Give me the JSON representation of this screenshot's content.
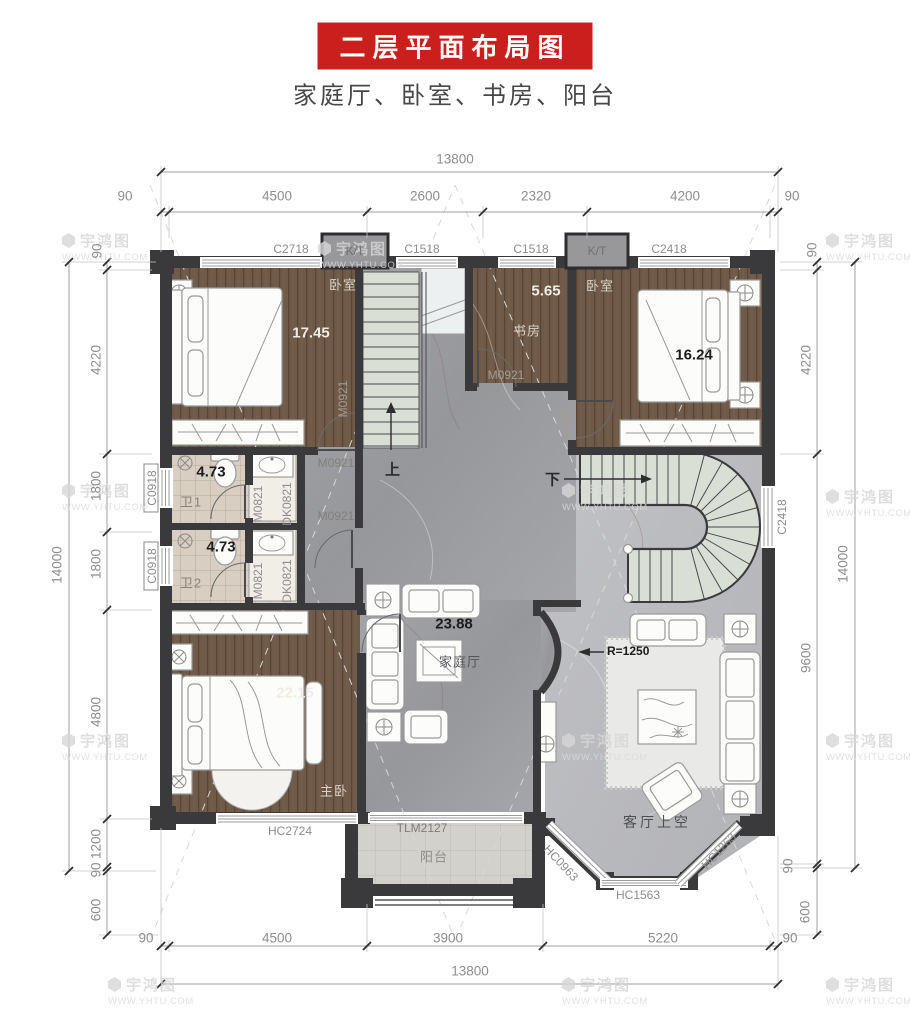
{
  "page": {
    "title_banner": "二层平面布局图",
    "subtitle": "家庭厅、卧室、书房、阳台"
  },
  "dimensions": {
    "top": {
      "total": "13800",
      "segments": [
        "90",
        "4500",
        "2600",
        "2320",
        "4200",
        "90"
      ]
    },
    "bottom": {
      "total": "13800",
      "segments": [
        "90",
        "4500",
        "3900",
        "5220",
        "90"
      ]
    },
    "left": {
      "total": "14000",
      "segments": [
        "90",
        "4220",
        "1800",
        "1800",
        "4800",
        "1200",
        "90",
        "600"
      ]
    },
    "right": {
      "total": "14000",
      "segments": [
        "90",
        "4220",
        "9600",
        "90",
        "600"
      ]
    }
  },
  "rooms": {
    "bedroom_top_left": {
      "name": "卧室",
      "area": "17.45"
    },
    "study": {
      "name": "书房",
      "area": "5.65"
    },
    "bedroom_top_right": {
      "name": "卧室",
      "area": "16.24"
    },
    "bath_1": {
      "name": "卫1",
      "area": "4.73"
    },
    "bath_2": {
      "name": "卫2",
      "area": "4.73"
    },
    "master_bedroom": {
      "name": "主卧",
      "area": "22.15"
    },
    "family_hall": {
      "name": "家庭厅",
      "area": "23.88"
    },
    "balcony": {
      "name": "阳台"
    },
    "living_void": {
      "name": "客厅上空"
    }
  },
  "stairs": {
    "up_label": "上",
    "down_label": "下",
    "radius_note": "R=1250"
  },
  "openings": {
    "windows_top": [
      "C2718",
      "C1518",
      "C1518",
      "C2418"
    ],
    "ac_platforms": [
      "K/T",
      "K/T"
    ],
    "windows_left": [
      "C0918",
      "C0918"
    ],
    "window_right": "C2418",
    "window_master": "HC2724",
    "balcony_door": "TLM2127",
    "bay_windows": [
      "HC0963",
      "HC1563",
      "HC1263"
    ],
    "doors_m0921": [
      "M0921",
      "M0921",
      "M0921",
      "M0921",
      "M0921"
    ],
    "doors_m0821": [
      "M0821",
      "M0821"
    ],
    "cabinets_dk0821": [
      "DK0821",
      "DK0821"
    ]
  },
  "watermark": {
    "brand": "宇鸿图",
    "url": "WWW.YHTU.COM"
  },
  "colors": {
    "banner_red": "#c9201e",
    "wall": "#3a3a3c",
    "wood": "#6f5947",
    "marble_hall": "#9c9da1",
    "marble_void": "#bcbdc0",
    "bath_tile": "#d8cfc2",
    "balcony_tile": "#d3d1cc",
    "stair_tread": "#dadfd6"
  }
}
